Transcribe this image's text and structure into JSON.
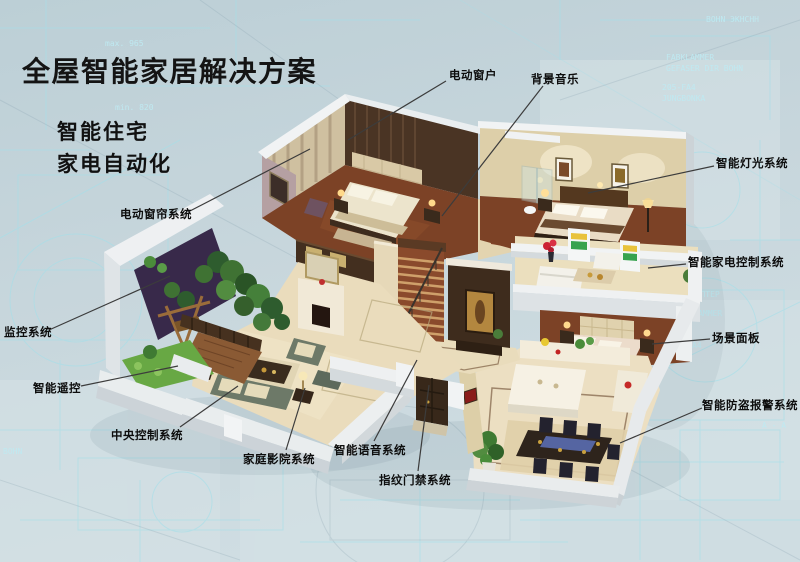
{
  "title": "全屋智能家居解决方案",
  "subtitles": [
    "智能住宅",
    "家电自动化"
  ],
  "callouts": [
    {
      "id": "electric-window",
      "label": "电动窗户"
    },
    {
      "id": "background-music",
      "label": "背景音乐"
    },
    {
      "id": "smart-lighting-system",
      "label": "智能灯光系统"
    },
    {
      "id": "smart-appliance-control-system",
      "label": "智能家电控制系统"
    },
    {
      "id": "scene-panel",
      "label": "场景面板"
    },
    {
      "id": "smart-burglar-alarm-system",
      "label": "智能防盗报警系统"
    },
    {
      "id": "electric-curtain-system",
      "label": "电动窗帘系统"
    },
    {
      "id": "monitoring-system",
      "label": "监控系统"
    },
    {
      "id": "smart-remote-control",
      "label": "智能遥控"
    },
    {
      "id": "central-control-system",
      "label": "中央控制系统"
    },
    {
      "id": "home-theater-system",
      "label": "家庭影院系统"
    },
    {
      "id": "smart-voice-system",
      "label": "智能语音系统"
    },
    {
      "id": "fingerprint-access-system",
      "label": "指纹门禁系统"
    }
  ],
  "background": {
    "texts": [
      "max. 965",
      "min. 820",
      "BOHN ЭКНСНН",
      "FABKLAMMER",
      "GEFASER DIR BOHN",
      "205-FA4",
      "JUNGBONKA",
      "АДАПТЕР",
      "FABKLAMMER",
      "200-FA4",
      "A - A",
      "BOHN"
    ],
    "base_color": "#c4d4da",
    "line_color": "#a5dfe9"
  },
  "colors": {
    "callout_line": "#3c3c3c",
    "label_text": "#0d0d0d",
    "wall_white": "#edf0f2",
    "wall_beige": "#ddcfa9",
    "dark_wood": "#4a3424",
    "wood_floor": "#7c4226",
    "marble_floor": "#eadcbc",
    "sofa_green": "#6d7968",
    "garden_green": "#4a7c3a",
    "accent_purple": "#38294a",
    "dining_table_runner": "#5565a2"
  }
}
